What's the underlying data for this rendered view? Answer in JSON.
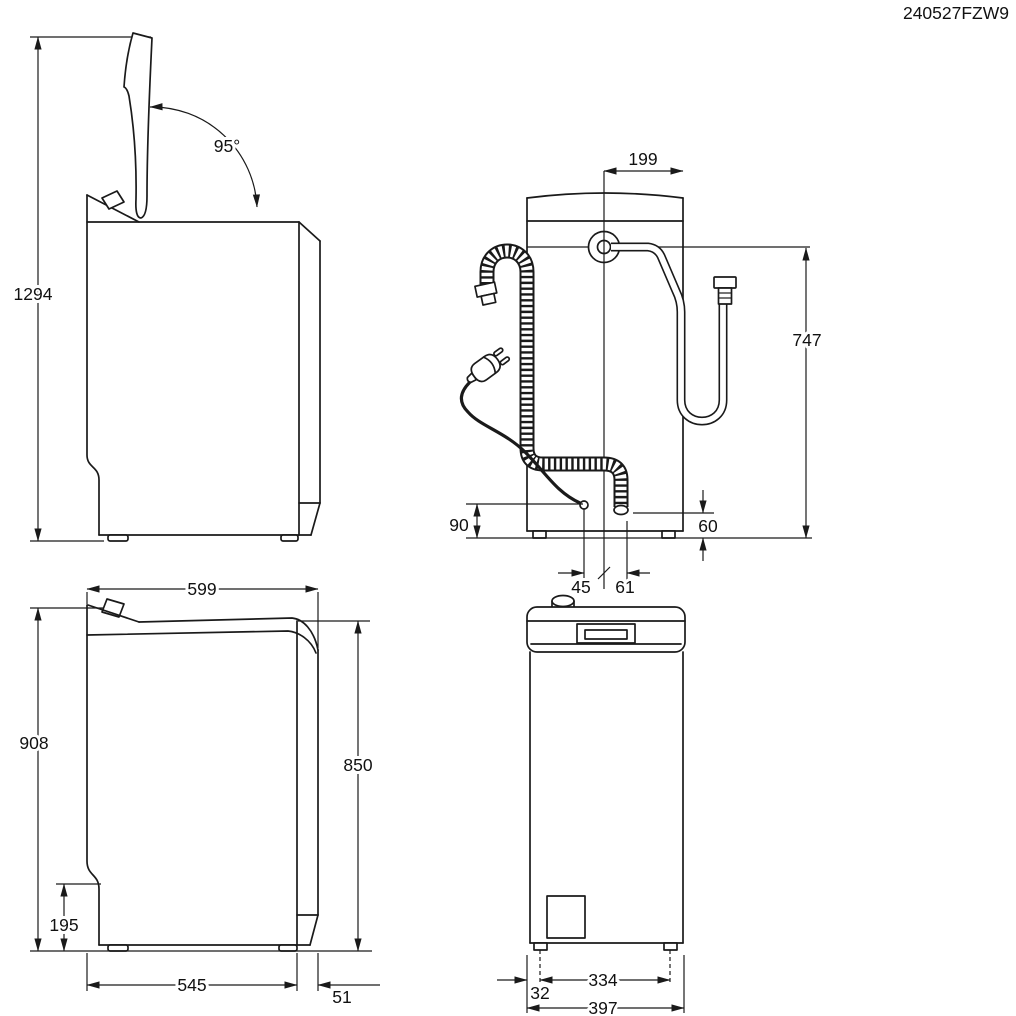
{
  "title_code": "240527FZW9",
  "views": {
    "side_open": {
      "name": "side-view-lid-open",
      "total_height_open": "1294",
      "lid_angle": "95°"
    },
    "rear": {
      "name": "rear-view",
      "inlet_offset": "199",
      "inlet_height": "747",
      "cord_exit_height": "90",
      "drain_exit_height": "60",
      "cord_offset": "45",
      "drain_offset": "61"
    },
    "side_closed": {
      "name": "side-view-closed",
      "depth_total": "599",
      "height_total": "908",
      "height_body": "850",
      "plinth_height": "195",
      "depth_base": "545",
      "rear_clearance": "51"
    },
    "front": {
      "name": "front-view",
      "feet_spacing": "334",
      "foot_inset": "32",
      "width": "397"
    }
  }
}
